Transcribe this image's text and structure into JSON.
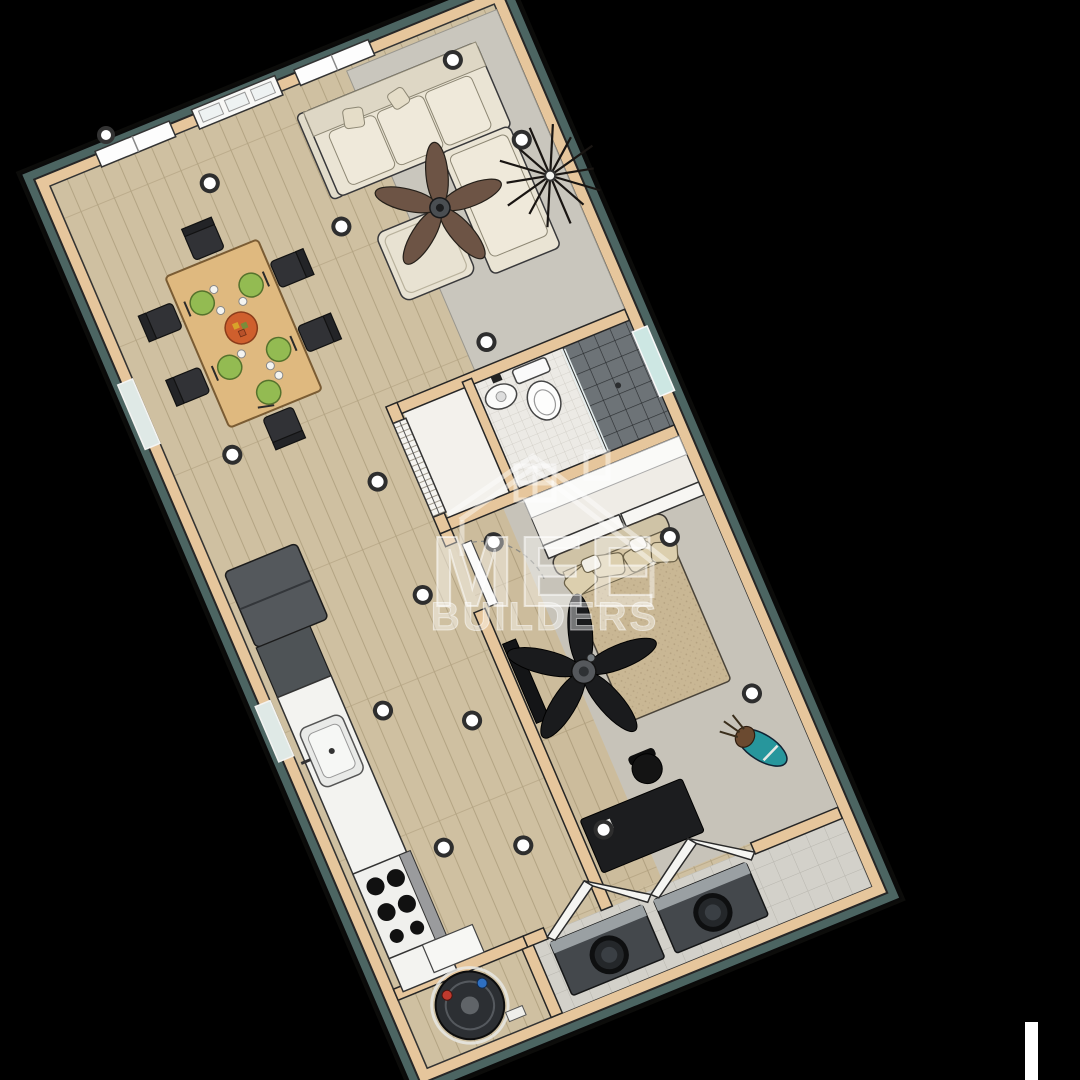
{
  "canvas": {
    "width": 1080,
    "height": 1080,
    "background": "#000000"
  },
  "watermark": {
    "brand": "MEE",
    "subtitle": "BUILDERS",
    "icon": "house-outline-icon",
    "color": "#ffffff"
  },
  "render": {
    "style": "3d-cutaway-floorplan-top-view",
    "rotation_deg": -22.5,
    "palette": {
      "background": "#000000",
      "wood_floor": "#cfc0a1",
      "plank_line": "#b3a483",
      "carpet_gray": "#c7c3b9",
      "rug_gray": "#c9c6bd",
      "wall_cap_tan": "#e6c69c",
      "siding_teal": "#4c6562",
      "wall_outline": "#262626",
      "fixture_white": "#f6f6f3",
      "sofa_cream": "#eae4d4",
      "fan_brown": "#6d5445",
      "fan_black": "#1a1b1d",
      "plate_green": "#93bb52",
      "centerpiece_orange": "#cf5f2d",
      "appliance_dark": "#44484c",
      "shower_tile": "#6d7377",
      "golf_bag_teal": "#27969c"
    },
    "rooms": [
      {
        "name": "living-room",
        "items": [
          "sectional-sofa",
          "ottoman",
          "brown-ceiling-fan",
          "starburst-decor",
          "gray-area-rug",
          "two-windows",
          "front-door"
        ]
      },
      {
        "name": "dining-area",
        "items": [
          "wood-dining-table",
          "six-dark-chairs",
          "five-green-place-settings",
          "orange-centerpiece"
        ]
      },
      {
        "name": "bathroom",
        "items": [
          "pedestal-sink",
          "toilet",
          "dark-tile-shower",
          "shower-window"
        ]
      },
      {
        "name": "hall-closet",
        "items": [
          "louvered-bifold-doors"
        ]
      },
      {
        "name": "hallway",
        "items": [
          "recessed-lights"
        ]
      },
      {
        "name": "bedroom",
        "items": [
          "bed-with-pillows",
          "black-ceiling-fan",
          "sliding-door-closet",
          "wall-tv",
          "desk",
          "office-chair",
          "golf-bag",
          "gray-carpet"
        ]
      },
      {
        "name": "kitchen",
        "items": [
          "refrigerator",
          "dark-counter",
          "white-counter",
          "sink",
          "range-with-burners"
        ]
      },
      {
        "name": "laundry-closet",
        "items": [
          "washer",
          "dryer",
          "bifold-doors",
          "tile-floor"
        ]
      },
      {
        "name": "water-heater-closet",
        "items": [
          "water-heater-tank",
          "red-valve",
          "blue-valve"
        ]
      }
    ],
    "recessed_light_count": 17
  },
  "artifact_bar": {
    "color": "#ffffff"
  }
}
